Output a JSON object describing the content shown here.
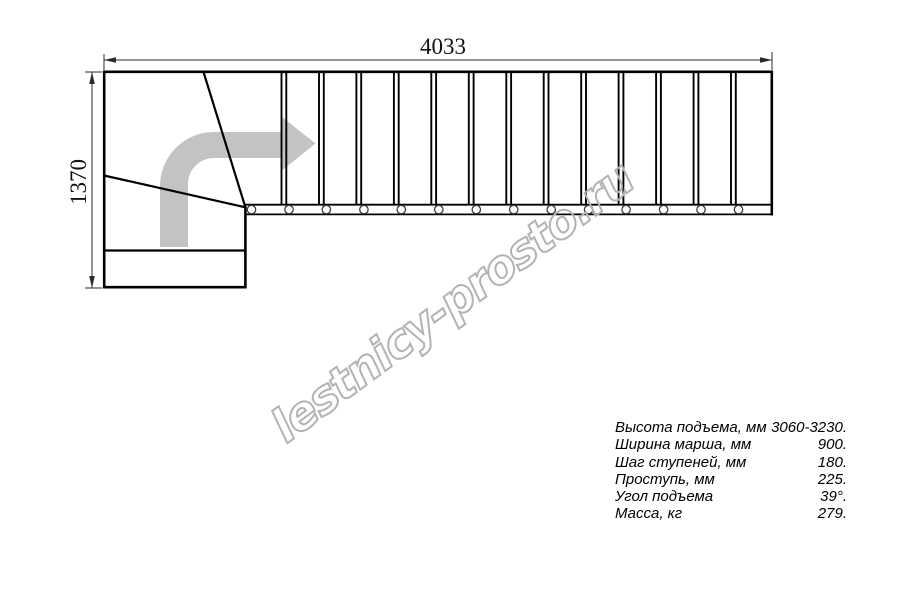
{
  "drawing": {
    "width_dim_label": "4033",
    "height_dim_label": "1370",
    "flight": {
      "tread_dividers": 13,
      "bolts": 14
    }
  },
  "specs": {
    "rows": [
      {
        "label": "Высота подъема, мм",
        "value": "3060-3230."
      },
      {
        "label": "Ширина марша, мм",
        "value": "900."
      },
      {
        "label": "Шаг ступеней, мм",
        "value": "180."
      },
      {
        "label": "Проступь, мм",
        "value": "225."
      },
      {
        "label": "Угол подъема",
        "value": "39°."
      },
      {
        "label": "Масса, кг",
        "value": "279."
      }
    ]
  },
  "watermark": {
    "text": "lestnicy-prosto.ru"
  },
  "colors": {
    "line": "#000000",
    "dimension": "#2a2a2a",
    "arrow": "#c3c3c3",
    "watermark": "#b3b3b3",
    "background": "#ffffff"
  }
}
